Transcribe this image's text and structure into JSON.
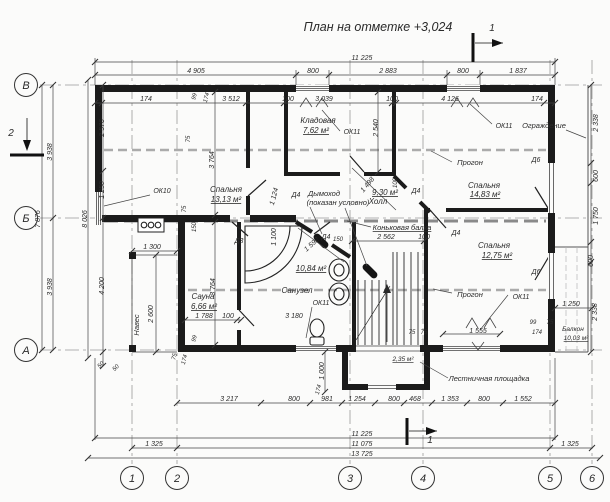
{
  "drawing": {
    "title": "План на отметке +3,024",
    "axis_columns": [
      {
        "label": "1",
        "x": 132
      },
      {
        "label": "2",
        "x": 177
      },
      {
        "label": "3",
        "x": 350
      },
      {
        "label": "4",
        "x": 423
      },
      {
        "label": "5",
        "x": 550
      },
      {
        "label": "6",
        "x": 592
      }
    ],
    "axis_rows": [
      {
        "label": "В",
        "y": 85
      },
      {
        "label": "Б",
        "y": 218
      },
      {
        "label": "А",
        "y": 350
      }
    ],
    "labels": [
      {
        "t": "11 225",
        "x": 362,
        "y": 60
      },
      {
        "t": "4 905",
        "x": 196,
        "y": 73
      },
      {
        "t": "800",
        "x": 313,
        "y": 73
      },
      {
        "t": "2 883",
        "x": 388,
        "y": 73
      },
      {
        "t": "800",
        "x": 463,
        "y": 73
      },
      {
        "t": "1 837",
        "x": 518,
        "y": 73
      },
      {
        "t": "174",
        "x": 146,
        "y": 101
      },
      {
        "t": "3 512",
        "x": 231,
        "y": 101
      },
      {
        "t": "100",
        "x": 288,
        "y": 101
      },
      {
        "t": "3 039",
        "x": 324,
        "y": 101
      },
      {
        "t": "100",
        "x": 392,
        "y": 101
      },
      {
        "t": "4 126",
        "x": 450,
        "y": 101
      },
      {
        "t": "174",
        "x": 537,
        "y": 101
      },
      {
        "t": "99",
        "x": 196,
        "y": 97,
        "r": -75,
        "s": 6
      },
      {
        "t": "174",
        "x": 208,
        "y": 98,
        "r": -75,
        "s": 6
      },
      {
        "t": "3 938",
        "x": 52,
        "y": 152,
        "r": -90
      },
      {
        "t": "3 938",
        "x": 52,
        "y": 287,
        "r": -90
      },
      {
        "t": "7 876",
        "x": 40,
        "y": 219,
        "r": -90
      },
      {
        "t": "8 026",
        "x": 87,
        "y": 219,
        "r": -90
      },
      {
        "t": "2 576",
        "x": 104,
        "y": 128,
        "r": -90
      },
      {
        "t": "1 250",
        "x": 104,
        "y": 190,
        "r": -90
      },
      {
        "t": "4 200",
        "x": 104,
        "y": 286,
        "r": -90
      },
      {
        "t": "50",
        "x": 102,
        "y": 366,
        "r": -45,
        "s": 6
      },
      {
        "t": "50",
        "x": 117,
        "y": 369,
        "r": -45,
        "s": 6
      },
      {
        "t": "1 300",
        "x": 152,
        "y": 249
      },
      {
        "t": "2 600",
        "x": 153,
        "y": 314,
        "r": -90
      },
      {
        "t": "Навес",
        "x": 139,
        "y": 325,
        "r": -90,
        "s": 7.5,
        "n": "annotation-canopy"
      },
      {
        "t": "2 338",
        "x": 598,
        "y": 123,
        "r": -90
      },
      {
        "t": "600",
        "x": 598,
        "y": 176,
        "r": -90
      },
      {
        "t": "1 750",
        "x": 598,
        "y": 216,
        "r": -90
      },
      {
        "t": "600",
        "x": 593,
        "y": 261,
        "r": -90
      },
      {
        "t": "2 338",
        "x": 597,
        "y": 312,
        "r": -90
      },
      {
        "t": "1 250",
        "x": 571,
        "y": 306
      },
      {
        "t": "3 217",
        "x": 229,
        "y": 401
      },
      {
        "t": "800",
        "x": 294,
        "y": 401
      },
      {
        "t": "981",
        "x": 327,
        "y": 401
      },
      {
        "t": "1 254",
        "x": 357,
        "y": 401
      },
      {
        "t": "800",
        "x": 394,
        "y": 401
      },
      {
        "t": "468",
        "x": 415,
        "y": 401
      },
      {
        "t": "1 353",
        "x": 450,
        "y": 401
      },
      {
        "t": "800",
        "x": 484,
        "y": 401
      },
      {
        "t": "1 552",
        "x": 523,
        "y": 401
      },
      {
        "t": "11 225",
        "x": 362,
        "y": 436
      },
      {
        "t": "1 325",
        "x": 154,
        "y": 446
      },
      {
        "t": "11 075",
        "x": 362,
        "y": 446
      },
      {
        "t": "1 325",
        "x": 570,
        "y": 446
      },
      {
        "t": "13 725",
        "x": 362,
        "y": 456
      },
      {
        "t": "1 000",
        "x": 324,
        "y": 371,
        "r": -90
      },
      {
        "t": "174",
        "x": 320,
        "y": 390,
        "r": -75,
        "s": 6
      },
      {
        "t": "3 764",
        "x": 214,
        "y": 160,
        "r": -90
      },
      {
        "t": "3 764",
        "x": 215,
        "y": 287,
        "r": -90
      },
      {
        "t": "2 540",
        "x": 378,
        "y": 128,
        "r": -90
      },
      {
        "t": "2 562",
        "x": 386,
        "y": 239
      },
      {
        "t": "100",
        "x": 424,
        "y": 239
      },
      {
        "t": "1 498",
        "x": 369,
        "y": 186,
        "r": -50
      },
      {
        "t": "1 592",
        "x": 313,
        "y": 246,
        "r": -42
      },
      {
        "t": "1 100",
        "x": 276,
        "y": 237,
        "r": -90
      },
      {
        "t": "1 124",
        "x": 276,
        "y": 197,
        "r": -75
      },
      {
        "t": "1 788",
        "x": 204,
        "y": 318
      },
      {
        "t": "100",
        "x": 228,
        "y": 318
      },
      {
        "t": "3 180",
        "x": 294,
        "y": 318
      },
      {
        "t": "75",
        "x": 186,
        "y": 209,
        "r": -90,
        "s": 6
      },
      {
        "t": "150",
        "x": 196,
        "y": 227,
        "r": -90,
        "s": 6
      },
      {
        "t": "75",
        "x": 190,
        "y": 139,
        "r": -90,
        "s": 6
      },
      {
        "t": "100",
        "x": 397,
        "y": 183,
        "r": -90,
        "s": 6
      },
      {
        "t": "99",
        "x": 196,
        "y": 339,
        "r": -75,
        "s": 6
      },
      {
        "t": "75",
        "x": 176,
        "y": 357,
        "r": -75,
        "s": 6
      },
      {
        "t": "174",
        "x": 186,
        "y": 360,
        "r": -75,
        "s": 6
      },
      {
        "t": "75",
        "x": 412,
        "y": 334,
        "s": 6
      },
      {
        "t": "75",
        "x": 424,
        "y": 334,
        "s": 6
      },
      {
        "t": "1 555",
        "x": 478,
        "y": 333
      },
      {
        "t": "174",
        "x": 537,
        "y": 334,
        "s": 6
      },
      {
        "t": "99",
        "x": 533,
        "y": 324,
        "s": 6
      },
      {
        "t": "75",
        "x": 550,
        "y": 324,
        "s": 6
      },
      {
        "t": "150",
        "x": 338,
        "y": 241,
        "s": 6
      },
      {
        "t": "Спальня",
        "x": 226,
        "y": 192,
        "s": 8,
        "n": "room-name-bedroom-1"
      },
      {
        "t": "13,13 м²",
        "x": 226,
        "y": 202,
        "s": 8,
        "u": 1,
        "n": "room-area-bedroom-1"
      },
      {
        "t": "Кладовая",
        "x": 318,
        "y": 123,
        "s": 8,
        "n": "room-name-storage"
      },
      {
        "t": "7,62 м²",
        "x": 316,
        "y": 133,
        "s": 8,
        "u": 1,
        "n": "room-area-storage"
      },
      {
        "t": "9,30 м²",
        "x": 385,
        "y": 195,
        "s": 8,
        "u": 1,
        "n": "room-area-hall"
      },
      {
        "t": "Холл",
        "x": 378,
        "y": 204,
        "s": 8,
        "n": "room-name-hall"
      },
      {
        "t": "Спальня",
        "x": 484,
        "y": 188,
        "s": 8,
        "n": "room-name-bedroom-2"
      },
      {
        "t": "14,83 м²",
        "x": 485,
        "y": 197,
        "s": 8,
        "u": 1,
        "n": "room-area-bedroom-2"
      },
      {
        "t": "Спальня",
        "x": 494,
        "y": 248,
        "s": 8,
        "n": "room-name-bedroom-3"
      },
      {
        "t": "12,75 м²",
        "x": 497,
        "y": 258,
        "s": 8,
        "u": 1,
        "n": "room-area-bedroom-3"
      },
      {
        "t": "Сауна",
        "x": 203,
        "y": 299,
        "s": 8,
        "n": "room-name-sauna"
      },
      {
        "t": "6,66 м²",
        "x": 204,
        "y": 309,
        "s": 8,
        "u": 1,
        "n": "room-area-sauna"
      },
      {
        "t": "10,84 м²",
        "x": 311,
        "y": 271,
        "s": 8,
        "u": 1,
        "n": "room-area-bathroom"
      },
      {
        "t": "Санузел",
        "x": 297,
        "y": 293,
        "s": 8,
        "n": "room-name-bathroom"
      },
      {
        "t": "Балкон",
        "x": 573,
        "y": 331,
        "s": 6.5,
        "n": "room-name-balcony"
      },
      {
        "t": "10,03 м²",
        "x": 576,
        "y": 340,
        "s": 6.5,
        "u": 1,
        "n": "room-area-balcony"
      },
      {
        "t": "2,35 м²",
        "x": 403,
        "y": 361,
        "s": 6.5,
        "u": 1,
        "n": "room-area-landing"
      },
      {
        "t": "ОК10",
        "x": 162,
        "y": 193,
        "n": "window-mark"
      },
      {
        "t": "ОК11",
        "x": 352,
        "y": 134,
        "n": "window-mark"
      },
      {
        "t": "ОК11",
        "x": 504,
        "y": 128,
        "n": "window-mark"
      },
      {
        "t": "ОК11",
        "x": 321,
        "y": 305,
        "n": "window-mark"
      },
      {
        "t": "ОК11",
        "x": 521,
        "y": 299,
        "n": "window-mark"
      },
      {
        "t": "Д3",
        "x": 239,
        "y": 243,
        "n": "door-mark"
      },
      {
        "t": "Д4",
        "x": 296,
        "y": 197,
        "n": "door-mark"
      },
      {
        "t": "Д4",
        "x": 416,
        "y": 193,
        "n": "door-mark"
      },
      {
        "t": "Д4",
        "x": 456,
        "y": 235,
        "n": "door-mark"
      },
      {
        "t": "Д4",
        "x": 326,
        "y": 239,
        "n": "door-mark"
      },
      {
        "t": "Д6",
        "x": 536,
        "y": 162,
        "n": "door-mark"
      },
      {
        "t": "Д6",
        "x": 536,
        "y": 274,
        "n": "door-mark"
      },
      {
        "t": "Дымоход",
        "x": 324,
        "y": 196,
        "s": 7.5,
        "n": "annotation-chimney"
      },
      {
        "t": "(показан условно)",
        "x": 338,
        "y": 205,
        "s": 7.5,
        "n": "annotation-chimney-note"
      },
      {
        "t": "Коньковая балка",
        "x": 402,
        "y": 230,
        "s": 7.5,
        "u": 1,
        "n": "annotation-ridge-beam"
      },
      {
        "t": "Прогон",
        "x": 470,
        "y": 165,
        "s": 7.5,
        "n": "annotation-purlin"
      },
      {
        "t": "Прогон",
        "x": 470,
        "y": 297,
        "s": 7.5,
        "n": "annotation-purlin"
      },
      {
        "t": "Ограждение",
        "x": 544,
        "y": 128,
        "s": 7.5,
        "n": "annotation-railing"
      },
      {
        "t": "Лестничная площадка",
        "x": 489,
        "y": 381,
        "s": 7.5,
        "n": "annotation-stair-landing"
      },
      {
        "t": "1",
        "x": 492,
        "y": 31,
        "s": 10,
        "n": "section-label"
      },
      {
        "t": "1",
        "x": 430,
        "y": 443,
        "s": 10,
        "n": "section-label"
      },
      {
        "t": "2",
        "x": 11,
        "y": 136,
        "s": 10,
        "n": "section-label"
      }
    ]
  },
  "colors": {
    "background": "#fbfbfa",
    "wall_line": "#1b1b1b",
    "dimension_line": "#444444",
    "axis_line": "#999999",
    "beam_line": "#aaaaaa",
    "text": "#2a2a2a"
  }
}
